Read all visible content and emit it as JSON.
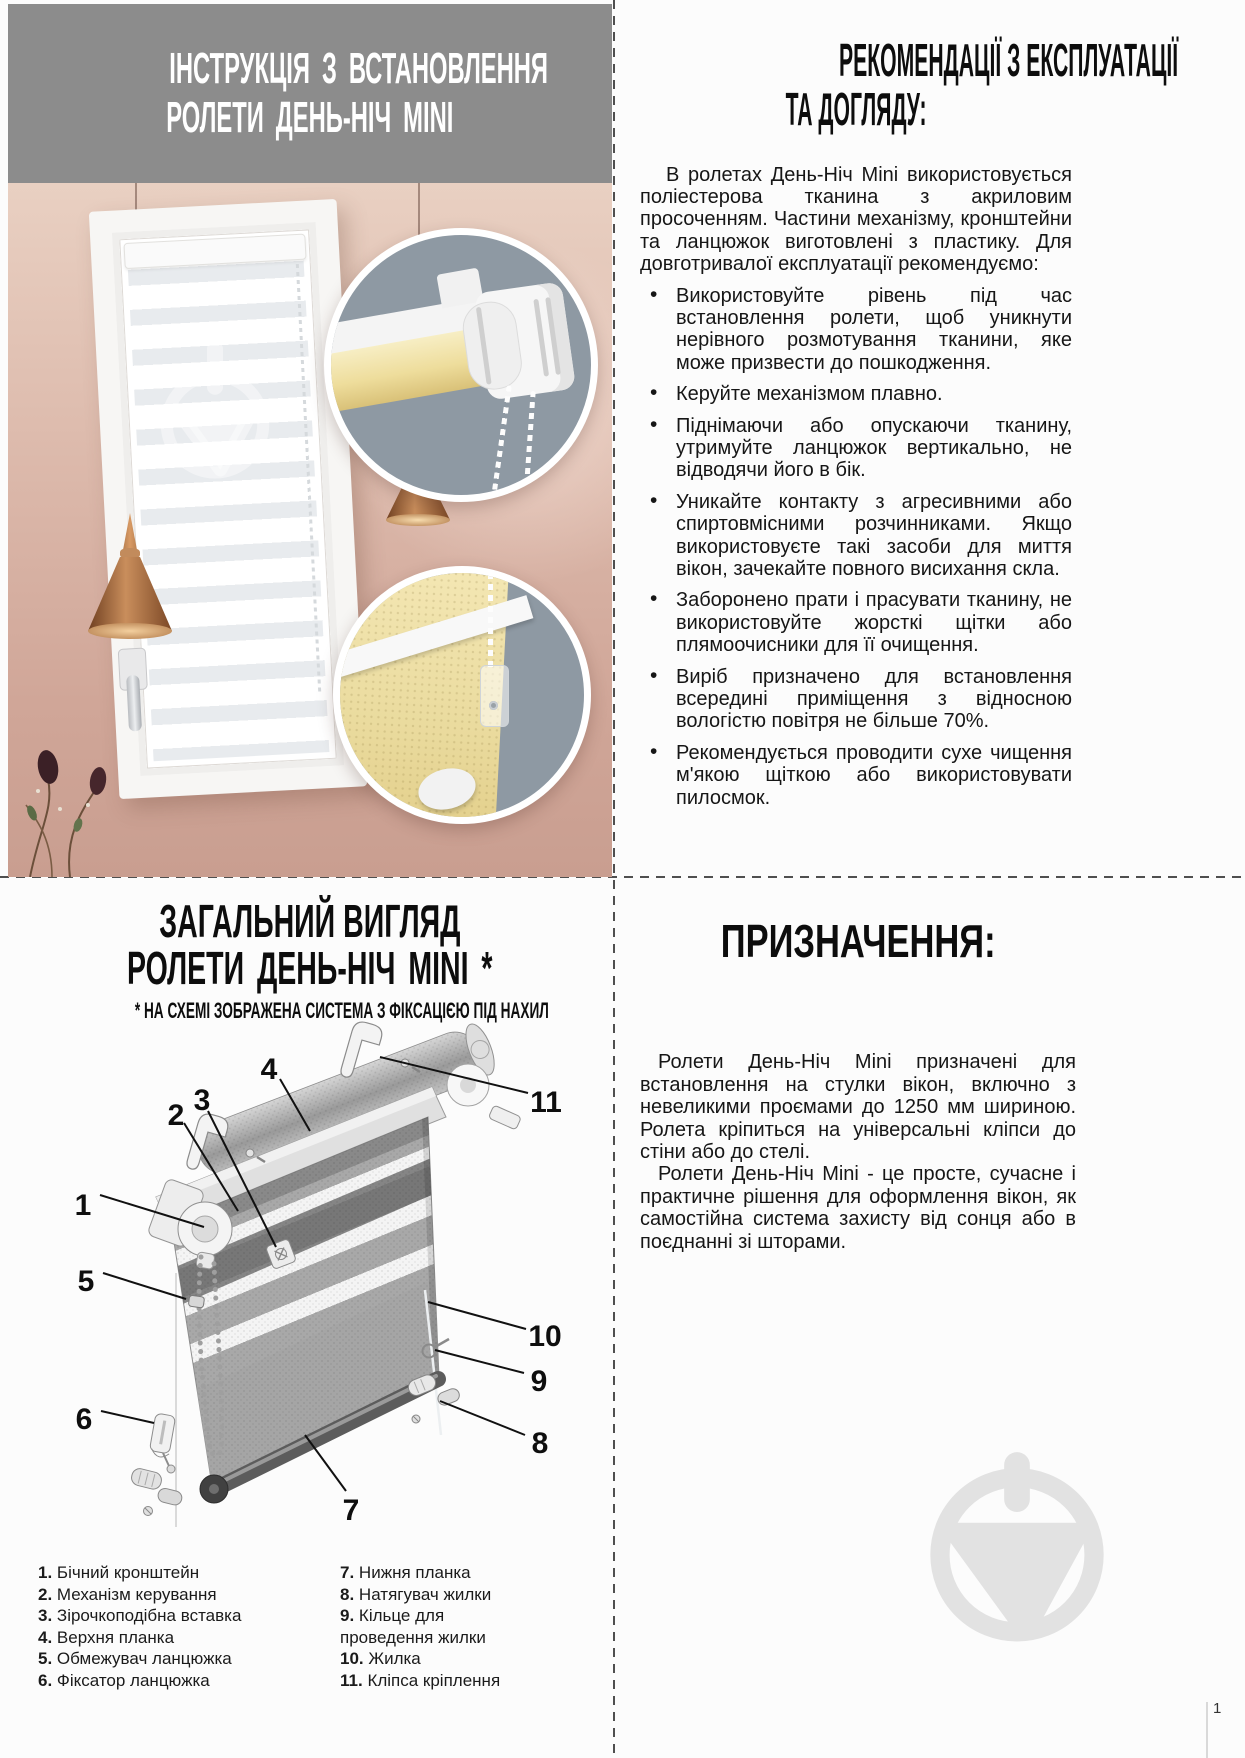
{
  "page": {
    "number": "1"
  },
  "colors": {
    "banner_gray": "#8c8c8c",
    "divider": "#4f4f4f",
    "watermark_gray": "#e2e2e2",
    "inset_background": "#8e99a3",
    "blind_yellow": "#efdfa2",
    "wall_pink": "#d8b2a4",
    "copper": "#b97f50"
  },
  "install": {
    "title_line1": "ІНСТРУКЦІЯ З ВСТАНОВЛЕННЯ",
    "title_line2": "РОЛЕТИ ДЕНЬ-НІЧ MINI"
  },
  "care": {
    "heading_line1": "РЕКОМЕНДАЦІЇ З ЕКСПЛУАТАЦІЇ",
    "heading_line2": "ТА ДОГЛЯДУ:",
    "intro": "В ролетах День-Ніч Mini використовується поліестерова тканина з акриловим просоченням. Частини механізму, кронштейни та ланцюжок виготовлені з пластику. Для довготривалої експлуатації рекомендуємо:",
    "bullets": [
      "Використовуйте рівень під час встановлення ролети, щоб уникнути нерівного розмотування тканини, яке може призвести до пошкодження.",
      "Керуйте механізмом плавно.",
      "Піднімаючи або опускаючи тканину, утримуйте ланцюжок вертикально, не відводячи його в бік.",
      "Уникайте контакту з агресивними або спиртовмісними розчинниками. Якщо використовуєте такі засоби для миття вікон, зачекайте повного висихання скла.",
      "Заборонено прати і прасувати тканину, не використовуйте жорсткі щітки або плямоочисники для її очищення.",
      "Виріб призначено для встановлення всередині приміщення з відносною вологістю повітря не більше 70%.",
      "Рекомендується проводити сухе чищення м'якою щіткою або використовувати пилосмок."
    ]
  },
  "overview": {
    "heading_line1": "ЗАГАЛЬНИЙ ВИГЛЯД",
    "heading_line2": "РОЛЕТИ ДЕНЬ-НІЧ MINI *",
    "note": "* НА СХЕМІ ЗОБРАЖЕНА СИСТЕМА З ФІКСАЦІЄЮ ПІД НАХИЛ",
    "callouts": [
      "1",
      "2",
      "3",
      "4",
      "5",
      "6",
      "7",
      "8",
      "9",
      "10",
      "11"
    ],
    "legend_left": [
      {
        "num": "1.",
        "label": "Бічний кронштейн"
      },
      {
        "num": "2.",
        "label": "Механізм керування"
      },
      {
        "num": "3.",
        "label": "Зірочкоподібна вставка"
      },
      {
        "num": "4.",
        "label": "Верхня планка"
      },
      {
        "num": "5.",
        "label": "Обмежувач ланцюжка"
      },
      {
        "num": "6.",
        "label": "Фіксатор ланцюжка"
      }
    ],
    "legend_right": [
      {
        "num": "7.",
        "label": "Нижня планка"
      },
      {
        "num": "8.",
        "label": "Натягувач жилки"
      },
      {
        "num": "9.",
        "label": "Кільце для\nпроведення жилки"
      },
      {
        "num": "10.",
        "label": "Жилка"
      },
      {
        "num": "11.",
        "label": "Кліпса кріплення"
      }
    ]
  },
  "purpose": {
    "heading": "ПРИЗНАЧЕННЯ:",
    "para1": "Ролети День-Ніч Mini призначені для встановлення на стулки вікон, включно з невеликими проємами до 1250 мм шириною. Ролета кріпиться на універсальні кліпси до стіни або до стелі.",
    "para2": "Ролети День-Ніч Mini - це просте, сучасне і практичне рішення для оформлення вікон, як самостійна система захисту від сонця або в поєднанні зі шторами."
  }
}
